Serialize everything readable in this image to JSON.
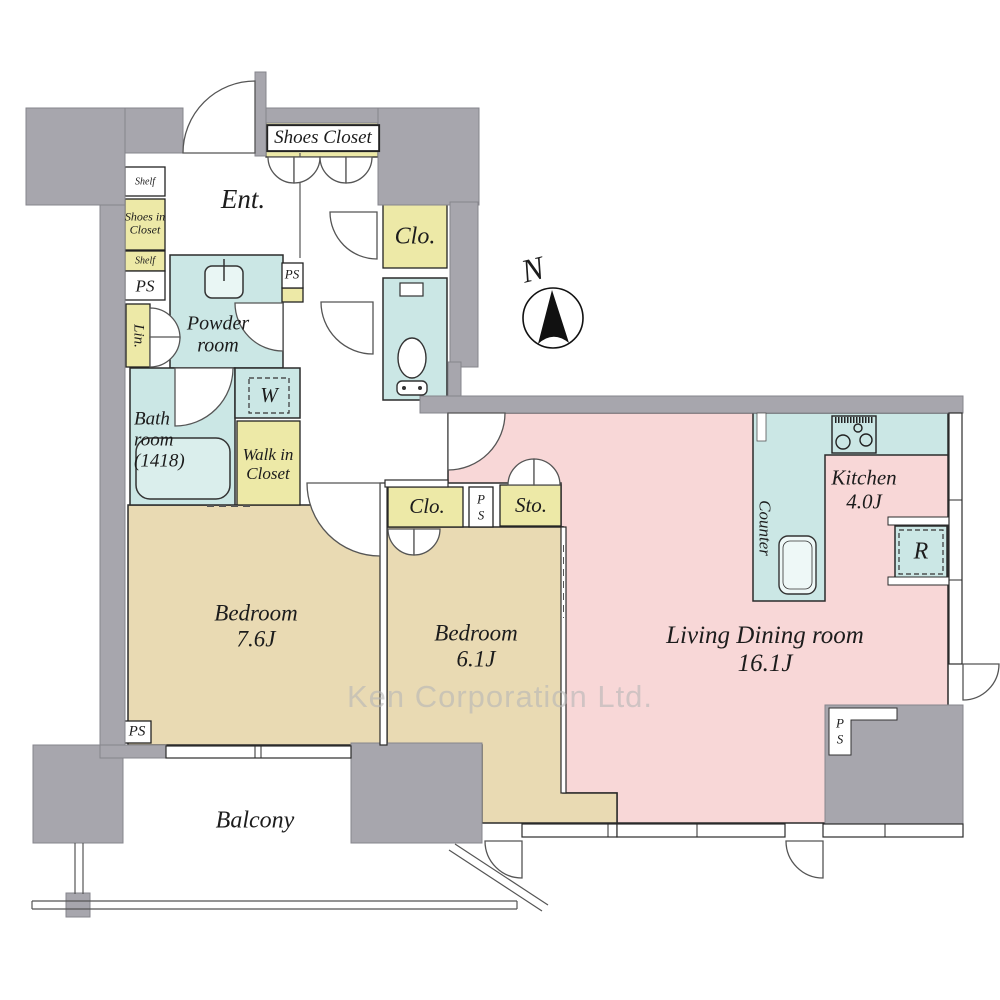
{
  "colors": {
    "wall_gray": "#a7a6ad",
    "closet_yellow": "#ede9a7",
    "wet_area_cyan": "#cbe7e5",
    "bedroom_tan": "#e9dab3",
    "living_pink": "#f8d7d7",
    "outline": "#2b2b2b",
    "watermark_gray": "#b6b6b6"
  },
  "compass": {
    "label": "N"
  },
  "watermark": {
    "text": "Ken Corporation Ltd."
  },
  "rooms": {
    "entrance": {
      "label": "Ent."
    },
    "shoes_closet": {
      "label": "Shoes Closet"
    },
    "shelf_upper": {
      "label": "Shelf"
    },
    "shoes_in_closet": {
      "line1": "Shoes in",
      "line2": "Closet"
    },
    "shelf_lower": {
      "label": "Shelf"
    },
    "ps_entrance": {
      "label": "PS"
    },
    "linen": {
      "label": "Lin."
    },
    "powder_room": {
      "line1": "Powder",
      "line2": "room"
    },
    "ps_powder": {
      "label": "PS"
    },
    "closet_hall": {
      "label": "Clo."
    },
    "bathroom": {
      "line1": "Bath",
      "line2": "room",
      "line3": "(1418)"
    },
    "washer": {
      "label": "W"
    },
    "walk_in_closet": {
      "line1": "Walk in",
      "line2": "Closet"
    },
    "bedroom_main": {
      "name": "Bedroom",
      "size": "7.6J"
    },
    "bedroom_second": {
      "name": "Bedroom",
      "size": "6.1J"
    },
    "closet_bedroom": {
      "label": "Clo."
    },
    "ps_bedroom": {
      "line1": "P",
      "line2": "S"
    },
    "storage": {
      "label": "Sto."
    },
    "living_dining": {
      "name": "Living Dining room",
      "size": "16.1J"
    },
    "kitchen": {
      "name": "Kitchen",
      "size": "4.0J"
    },
    "counter": {
      "label": "Counter"
    },
    "refrigerator": {
      "label": "R"
    },
    "ps_bedroom_main": {
      "label": "PS"
    },
    "ps_living": {
      "line1": "P",
      "line2": "S"
    },
    "balcony": {
      "label": "Balcony"
    }
  }
}
